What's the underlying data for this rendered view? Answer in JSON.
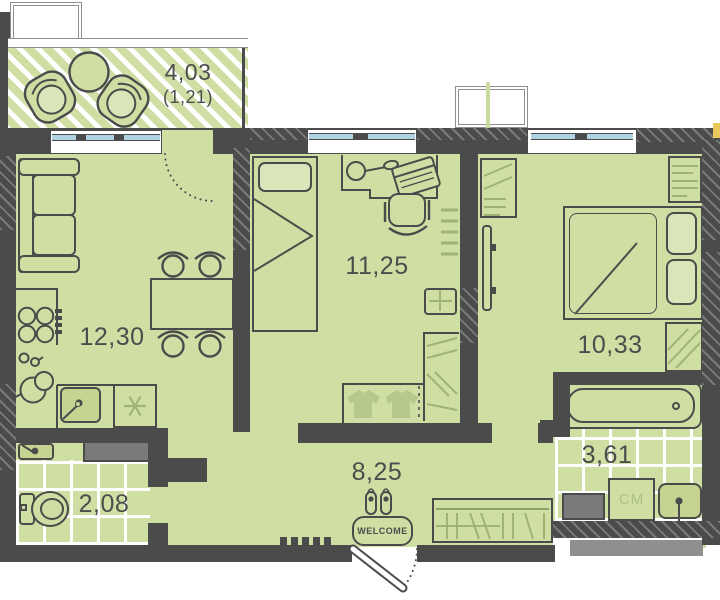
{
  "floorplan": {
    "areas": {
      "balcony": "4,03",
      "balcony_reduced": "(1,21)",
      "living_kitchen": "12,30",
      "bedroom_middle": "11,25",
      "bedroom_right": "10,33",
      "hallway": "8,25",
      "bathroom": "3,61",
      "wc": "2,08"
    },
    "labels": {
      "washing_machine": "СМ",
      "doormat": "WELCOME"
    },
    "colors": {
      "wall": "#4b4b4b",
      "floor": "#cfdfa3",
      "window_glass": "#aed3e2",
      "furniture_accent": "#9fb474",
      "tile_line": "#ffffff",
      "shaft_gray": "#7a7a7a",
      "marker_yellow": "#e8c85a"
    }
  }
}
